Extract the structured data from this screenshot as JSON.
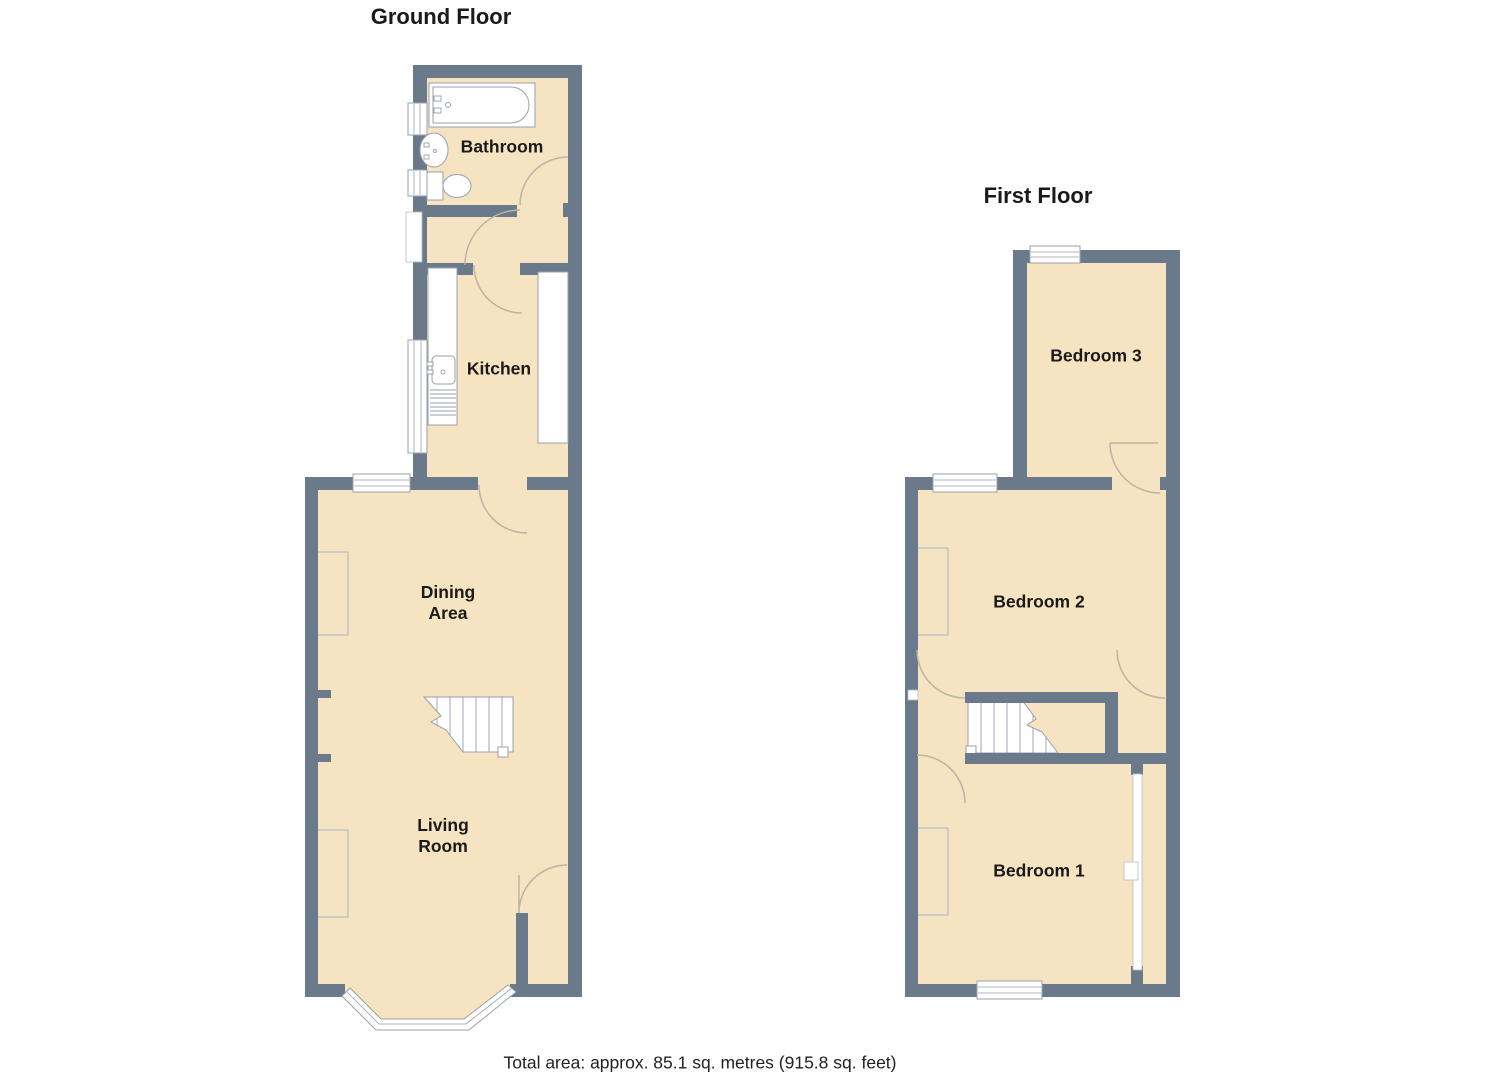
{
  "titles": {
    "ground": "Ground Floor",
    "first": "First Floor"
  },
  "caption": "Total area: approx. 85.1 sq. metres (915.8 sq. feet)",
  "rooms": {
    "bathroom": {
      "label": "Bathroom"
    },
    "kitchen": {
      "label": "Kitchen"
    },
    "dining": {
      "line1": "Dining",
      "line2": "Area"
    },
    "living": {
      "line1": "Living",
      "line2": "Room"
    },
    "bedroom3": {
      "label": "Bedroom 3"
    },
    "bedroom2": {
      "label": "Bedroom 2"
    },
    "bedroom1": {
      "label": "Bedroom 1"
    }
  },
  "fixtures": [
    "bathtub",
    "bathroom-sink",
    "toilet",
    "kitchen-sink",
    "kitchen-counter",
    "staircase",
    "bay-window",
    "window",
    "door-swing",
    "chimney-breast"
  ],
  "colors": {
    "wall": "#6b7a8b",
    "floor": "#f5e3c2",
    "outline": "#98a1ab",
    "door_arc": "#bdb4a2",
    "text": "#1a1a1a",
    "window_fill": "#ffffff"
  }
}
